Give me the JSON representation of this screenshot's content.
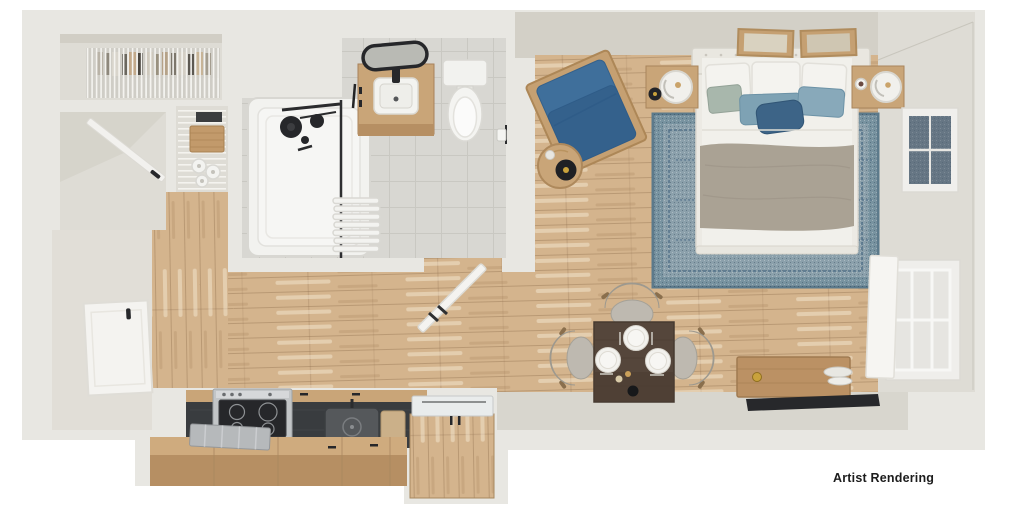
{
  "annotation": {
    "label": "Artist Rendering"
  },
  "palette": {
    "bg": "#ffffff",
    "wall": "#e8e7e2",
    "wall-shade": "#dedcd5",
    "wall-face": "#d3d0c7",
    "wall-face-dark": "#c8c5bb",
    "wood": "#d4b48d",
    "tile": "#d8d7d2",
    "tile-line": "#c9c8c2",
    "fixture-white": "#f3f3f0",
    "fixture-line": "#d9d8d3",
    "black-fixture": "#26272a",
    "steel": "#c2c5c7",
    "counter-dark": "#393c3f",
    "cabinet-wood": "#c9a578",
    "cabinet-wood-dark": "#b68f63",
    "chair-blue": "#3f6f9b",
    "chair-blue-deep": "#34618c",
    "frame-wood": "#c5a072",
    "rug-base": "#8ba0ab",
    "rug-border": "#5c7a8b",
    "rug-motif": "#54728a",
    "sheet-white": "#f1f0eb",
    "blanket": "#aaa294",
    "pillow-steel": "#7ea2b4",
    "pillow-sage": "#a8b7ac",
    "pillow-navy": "#3d6487",
    "walnut": "#55463b",
    "chair-gray": "#b4b0a7",
    "console-wood": "#bb9164",
    "tv-black": "#27282b",
    "gold": "#c9a23c",
    "label": "#1c1c1c"
  },
  "objects": {
    "rooms": [
      "entry",
      "closet",
      "pantry",
      "bathroom",
      "kitchen",
      "living-sleeping-area"
    ],
    "furniture": [
      "wire-shelf",
      "pantry-shelving",
      "wardrobe-door",
      "entry-door",
      "bathtub",
      "shower-fixture",
      "towel-radiator",
      "vanity-sink",
      "vanity-mirror",
      "toilet",
      "toilet-paper-holder",
      "bathroom-door",
      "stove",
      "kitchen-sink",
      "dish-rack",
      "cutting-board",
      "kitchen-cabinets",
      "refrigerator",
      "armchair",
      "side-table",
      "area-rug",
      "bed",
      "nightstand-left",
      "nightstand-right",
      "lamp",
      "wall-art",
      "dining-table",
      "dining-chair",
      "place-setting",
      "media-console",
      "tv",
      "window-upper",
      "window-lower",
      "closet-door-panel"
    ]
  }
}
